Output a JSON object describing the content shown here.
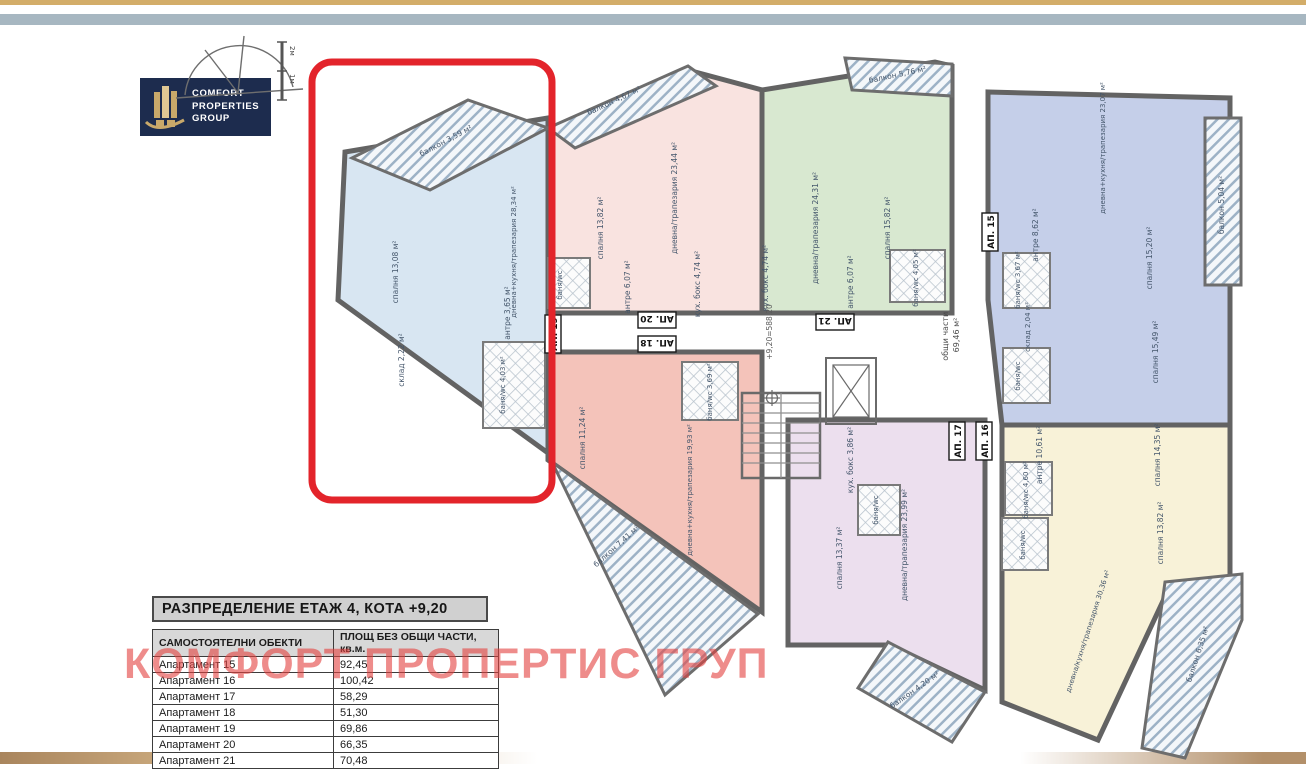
{
  "page": {
    "title_block": "РАЗПРЕДЕЛЕНИЕ ЕТАЖ 4, КОТА +9,20",
    "watermark": "КОМФОРТ ПРОПЕРТИС ГРУП"
  },
  "logo": {
    "line1": "COMFORT",
    "line2": "PROPERTIES",
    "line3": "GROUP"
  },
  "scale": {
    "m1": "1м",
    "m2": "2м"
  },
  "table": {
    "headers": {
      "objects": "САМОСТОЯТЕЛНИ ОБЕКТИ",
      "area": "ПЛОЩ БЕЗ ОБЩИ ЧАСТИ, кв.м."
    },
    "rows": [
      {
        "name": "Апартамент 15",
        "area": "92,45"
      },
      {
        "name": "Апартамент 16",
        "area": "100,42"
      },
      {
        "name": "Апартамент 17",
        "area": "58,29"
      },
      {
        "name": "Апартамент 18",
        "area": "51,30"
      },
      {
        "name": "Апартамент 19",
        "area": "69,86"
      },
      {
        "name": "Апартамент 20",
        "area": "66,35"
      },
      {
        "name": "Апартамент 21",
        "area": "70,48"
      }
    ]
  },
  "plan": {
    "common": {
      "name": "общи части",
      "area": "69,46 м²",
      "elevation": "+9,20=588,20"
    },
    "apartments": {
      "ap19": {
        "label": "АП. 19",
        "color": "#d8e6f2",
        "rooms": [
          {
            "name": "балкон",
            "area": "3,59 м²"
          },
          {
            "name": "спалня",
            "area": "13,08 м²"
          },
          {
            "name": "дневна+кухня/трапезария",
            "area": "28,34 м²"
          },
          {
            "name": "склад",
            "area": "2,22 м²"
          },
          {
            "name": "антре",
            "area": "3,65 м²"
          },
          {
            "name": "баня/wc",
            "area": "4,03 м²"
          }
        ]
      },
      "ap20": {
        "label": "АП. 20",
        "color": "#f9e3e0",
        "rooms": [
          {
            "name": "балкон",
            "area": "4,67 м²"
          },
          {
            "name": "спалня",
            "area": "13,82 м²"
          },
          {
            "name": "дневна/трапезария",
            "area": "23,44 м²"
          },
          {
            "name": "антре",
            "area": "6,07 м²"
          },
          {
            "name": "кух. бокс",
            "area": "4,74 м²"
          },
          {
            "name": "баня/wc",
            "area": ""
          }
        ]
      },
      "ap21": {
        "label": "АП. 21",
        "color": "#d8e8d0",
        "rooms": [
          {
            "name": "балкон",
            "area": "5,76 м²"
          },
          {
            "name": "дневна/трапезария",
            "area": "24,31 м²"
          },
          {
            "name": "спалня",
            "area": "15,82 м²"
          },
          {
            "name": "кух. бокс",
            "area": "4,74 м²"
          },
          {
            "name": "антре",
            "area": "6,07 м²"
          },
          {
            "name": "баня/wc",
            "area": "4,05 м²"
          }
        ]
      },
      "ap15": {
        "label": "АП. 15",
        "color": "#c5cfe9",
        "rooms": [
          {
            "name": "дневна+кухня/трапезария",
            "area": "23,07 м²"
          },
          {
            "name": "балкон",
            "area": "5,04 м²"
          },
          {
            "name": "антре",
            "area": "8,62 м²"
          },
          {
            "name": "спалня",
            "area": "15,20 м²"
          },
          {
            "name": "спалня",
            "area": "15,49 м²"
          },
          {
            "name": "склад",
            "area": "2,04 м²"
          },
          {
            "name": "баня/wc",
            "area": "3,67 м²"
          },
          {
            "name": "баня/wc",
            "area": ""
          }
        ]
      },
      "ap16": {
        "label": "АП. 16",
        "color": "#f8f2d8",
        "rooms": [
          {
            "name": "антре",
            "area": "10,61 м²"
          },
          {
            "name": "спалня",
            "area": "14,35 м²"
          },
          {
            "name": "спалня",
            "area": "13,82 м²"
          },
          {
            "name": "дневна/кухня/трапезария",
            "area": "30,36 м²"
          },
          {
            "name": "балкон",
            "area": "6,35 м²"
          },
          {
            "name": "баня/wc",
            "area": "4,60 м²"
          },
          {
            "name": "баня/wc",
            "area": ""
          }
        ]
      },
      "ap17": {
        "label": "АП. 17",
        "color": "#ecdfee",
        "rooms": [
          {
            "name": "кух. бокс",
            "area": "3,86 м²"
          },
          {
            "name": "спалня",
            "area": "13,37 м²"
          },
          {
            "name": "дневна/трапезария",
            "area": "23,99 м²"
          },
          {
            "name": "балкон",
            "area": "4,20 м²"
          },
          {
            "name": "баня/wc",
            "area": ""
          }
        ]
      },
      "ap18": {
        "label": "АП. 18",
        "color": "#f4c3ba",
        "rooms": [
          {
            "name": "спалня",
            "area": "11,24 м²"
          },
          {
            "name": "дневна+кухня/трапезария",
            "area": "19,93 м²"
          },
          {
            "name": "балкон",
            "area": "7,41 м²"
          },
          {
            "name": "баня/wc",
            "area": "3,69 м²"
          }
        ]
      }
    }
  },
  "colors": {
    "highlight_red": "#e3242b",
    "logo_navy": "#1d2c4e",
    "logo_gold": "#c9a96a",
    "band_gold": "#d3ad69",
    "band_blue": "#a7b7c1",
    "band_tan": "#b3906a",
    "wall_gray": "#636363",
    "watermark_red": "#e4413f"
  }
}
